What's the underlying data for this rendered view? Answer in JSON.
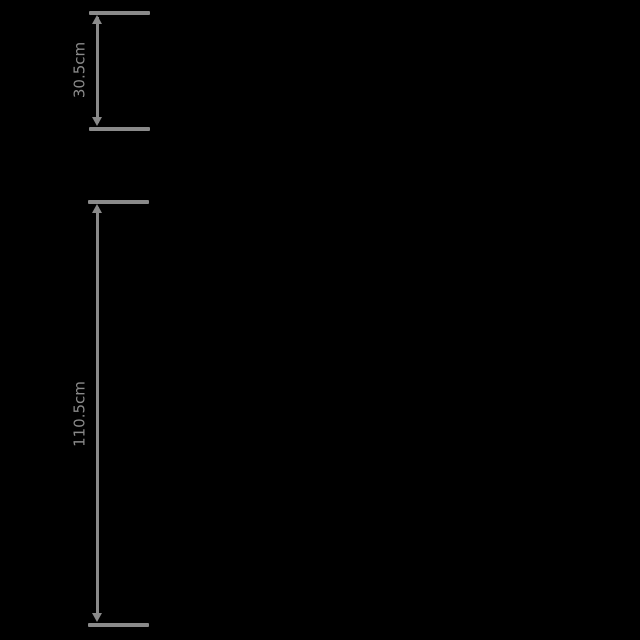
{
  "canvas": {
    "background_color": "#000000",
    "annotation_color": "#8a8a8a",
    "description": "Product dimension diagram on black background; only the two vertical measurement callouts on the left are visible"
  },
  "dimensions": [
    {
      "id": "top-dimension",
      "label": "30.5cm",
      "orientation": "vertical",
      "label_rotation_deg": -90
    },
    {
      "id": "bottom-dimension",
      "label": "110.5cm",
      "orientation": "vertical",
      "label_rotation_deg": -90
    }
  ]
}
